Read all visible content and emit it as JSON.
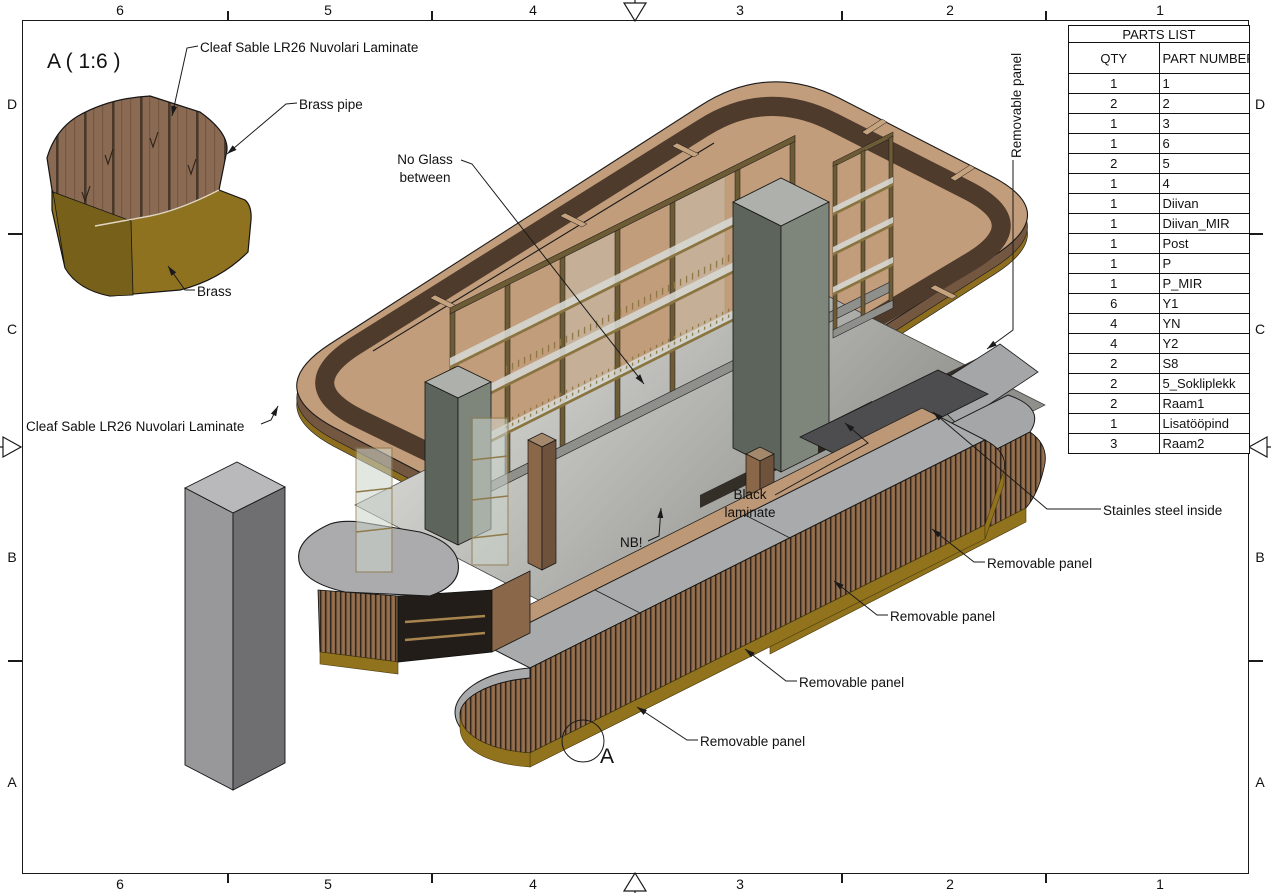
{
  "border": {
    "top": [
      "6",
      "5",
      "4",
      "3",
      "2",
      "1"
    ],
    "bottom": [
      "6",
      "5",
      "4",
      "3",
      "2",
      "1"
    ],
    "left": [
      "D",
      "C",
      "B",
      "A"
    ],
    "right": [
      "D",
      "C",
      "B",
      "A"
    ]
  },
  "parts_list": {
    "title": "PARTS LIST",
    "columns": [
      "QTY",
      "PART NUMBER"
    ],
    "rows": [
      [
        "1",
        "1"
      ],
      [
        "2",
        "2"
      ],
      [
        "1",
        "3"
      ],
      [
        "1",
        "6"
      ],
      [
        "2",
        "5"
      ],
      [
        "1",
        "4"
      ],
      [
        "1",
        "Diivan"
      ],
      [
        "1",
        "Diivan_MIR"
      ],
      [
        "1",
        "Post"
      ],
      [
        "1",
        "P"
      ],
      [
        "1",
        "P_MIR"
      ],
      [
        "6",
        "Y1"
      ],
      [
        "4",
        "YN"
      ],
      [
        "4",
        "Y2"
      ],
      [
        "2",
        "S8"
      ],
      [
        "2",
        "5_Sokliplekk"
      ],
      [
        "2",
        "Raam1"
      ],
      [
        "1",
        "Lisatööpind"
      ],
      [
        "3",
        "Raam2"
      ]
    ]
  },
  "annotations": {
    "detail_title": "A ( 1:6 )",
    "cleaf_top": "Cleaf Sable LR26 Nuvolari Laminate",
    "brass_pipe": "Brass pipe",
    "brass": "Brass",
    "no_glass": "No Glass\nbetween",
    "removable_panel_vertical": "Removable panel",
    "cleaf_left": "Cleaf Sable LR26 Nuvolari Laminate",
    "nb": "NB!",
    "black_laminate": "Black\nlaminate",
    "stainless_steel": "Stainles steel inside",
    "removable_panel_1": "Removable panel",
    "removable_panel_2": "Removable panel",
    "removable_panel_3": "Removable panel",
    "removable_panel_4": "Removable panel",
    "detail_callout": "A"
  },
  "colors": {
    "line": "#1a1a1a",
    "wood_slat": "#8a6749",
    "wood_rail": "#c29d7b",
    "wood_channel": "#4e3b2c",
    "brass": "#91731d",
    "counter_gray": "#a9aaac",
    "stainless_dark": "#4d4d50",
    "cabinet_green": "#5d645c",
    "column_gray": "#98989b"
  }
}
